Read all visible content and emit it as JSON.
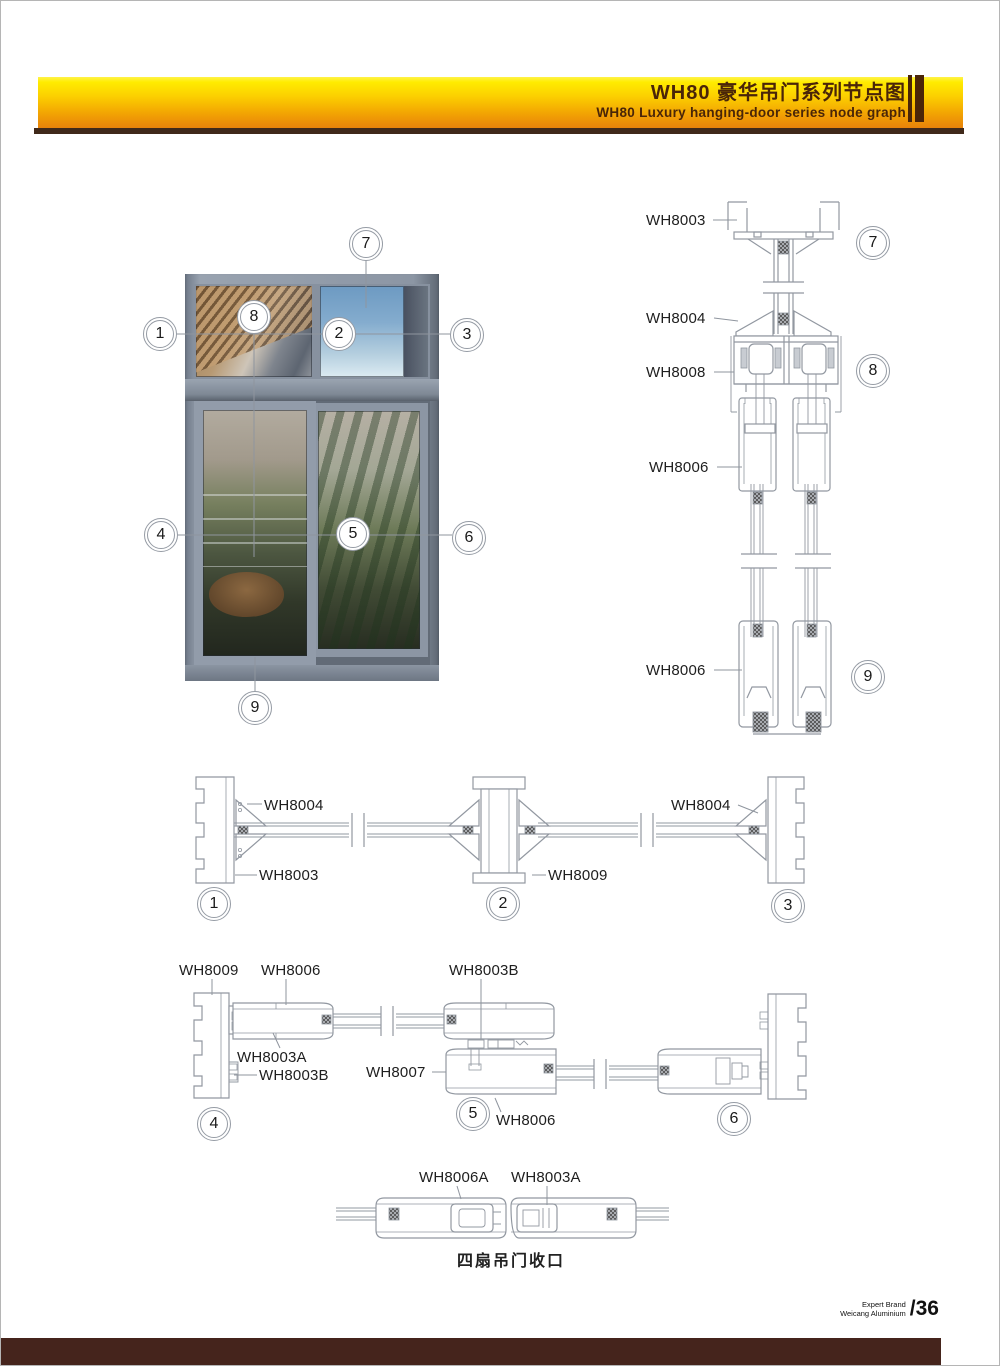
{
  "header": {
    "title_cn": "WH80 豪华吊门系列节点图",
    "title_en": "WH80 Luxury hanging-door series node graph"
  },
  "overview": {
    "callouts": [
      "1",
      "2",
      "3",
      "4",
      "5",
      "6",
      "7",
      "8",
      "9"
    ]
  },
  "vertical_sections": {
    "labels": [
      "WH8003",
      "WH8004",
      "WH8008",
      "WH8006",
      "WH8006"
    ],
    "callouts": [
      "7",
      "8",
      "9"
    ]
  },
  "horizontal_sections": {
    "labels": [
      "WH8004",
      "WH8003",
      "WH8009",
      "WH8004"
    ],
    "callouts": [
      "1",
      "2",
      "3"
    ]
  },
  "door_sections": {
    "labels": [
      "WH8009",
      "WH8006",
      "WH8003B",
      "WH8003A",
      "WH8003B",
      "WH8007",
      "WH8006"
    ],
    "callouts": [
      "4",
      "5",
      "6"
    ]
  },
  "closeup": {
    "labels": [
      "WH8006A",
      "WH8003A"
    ],
    "caption": "四扇吊门收口"
  },
  "footer": {
    "brand_line1": "Expert Brand",
    "brand_line2": "Weicang Aluminium",
    "page_number": "/36"
  },
  "colors": {
    "band_yellow": "#ffec00",
    "band_orange": "#e8820a",
    "band_text": "#4a2508",
    "underline_brown": "#40291a",
    "footer_bar": "#45241c",
    "drawing_line": "#9298a1"
  }
}
